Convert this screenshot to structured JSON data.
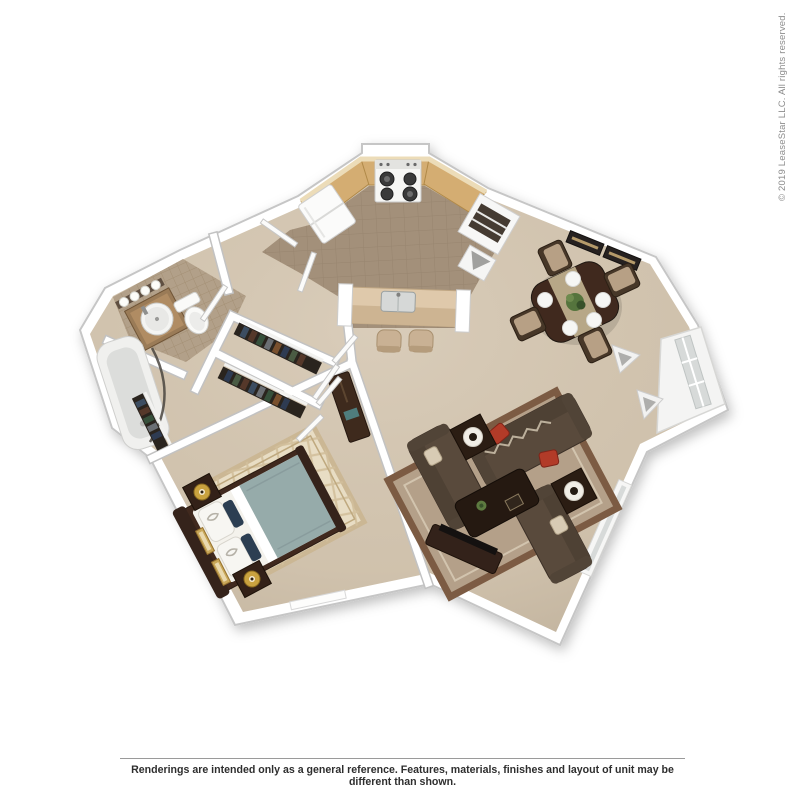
{
  "watermark": {
    "copyright": "© 2019 LeaseStar LLC. All rights reserved."
  },
  "footer": {
    "disclaimer": "Renderings are intended only as a general reference. Features, materials, finishes and layout of unit may be different than shown."
  },
  "floorplan": {
    "kind": "3d-rendered-floor-plan",
    "rooms": [
      "kitchen",
      "dining-area",
      "living-room",
      "bedroom",
      "bathroom",
      "closets",
      "entry-hall"
    ],
    "colors": {
      "carpet": "#d5c7b2",
      "kitchen_tile": "#a3907a",
      "bath_tile": "#b2a089",
      "counter_wood": "#d4ad72",
      "island_top": "#dfc9ab",
      "wall": "#ffffff",
      "sofa": "#594a3c",
      "dark_wood": "#40291e",
      "red_accent": "#b23b28",
      "cream_pillow": "#d8cbb4",
      "bed_duvet": "#96abaa",
      "rug_living": "#b4a089",
      "rug_bedroom": "#e8ddc4",
      "gold": "#c9a23f",
      "tv_black": "#141110",
      "window_glass": "#d7dad9"
    }
  }
}
